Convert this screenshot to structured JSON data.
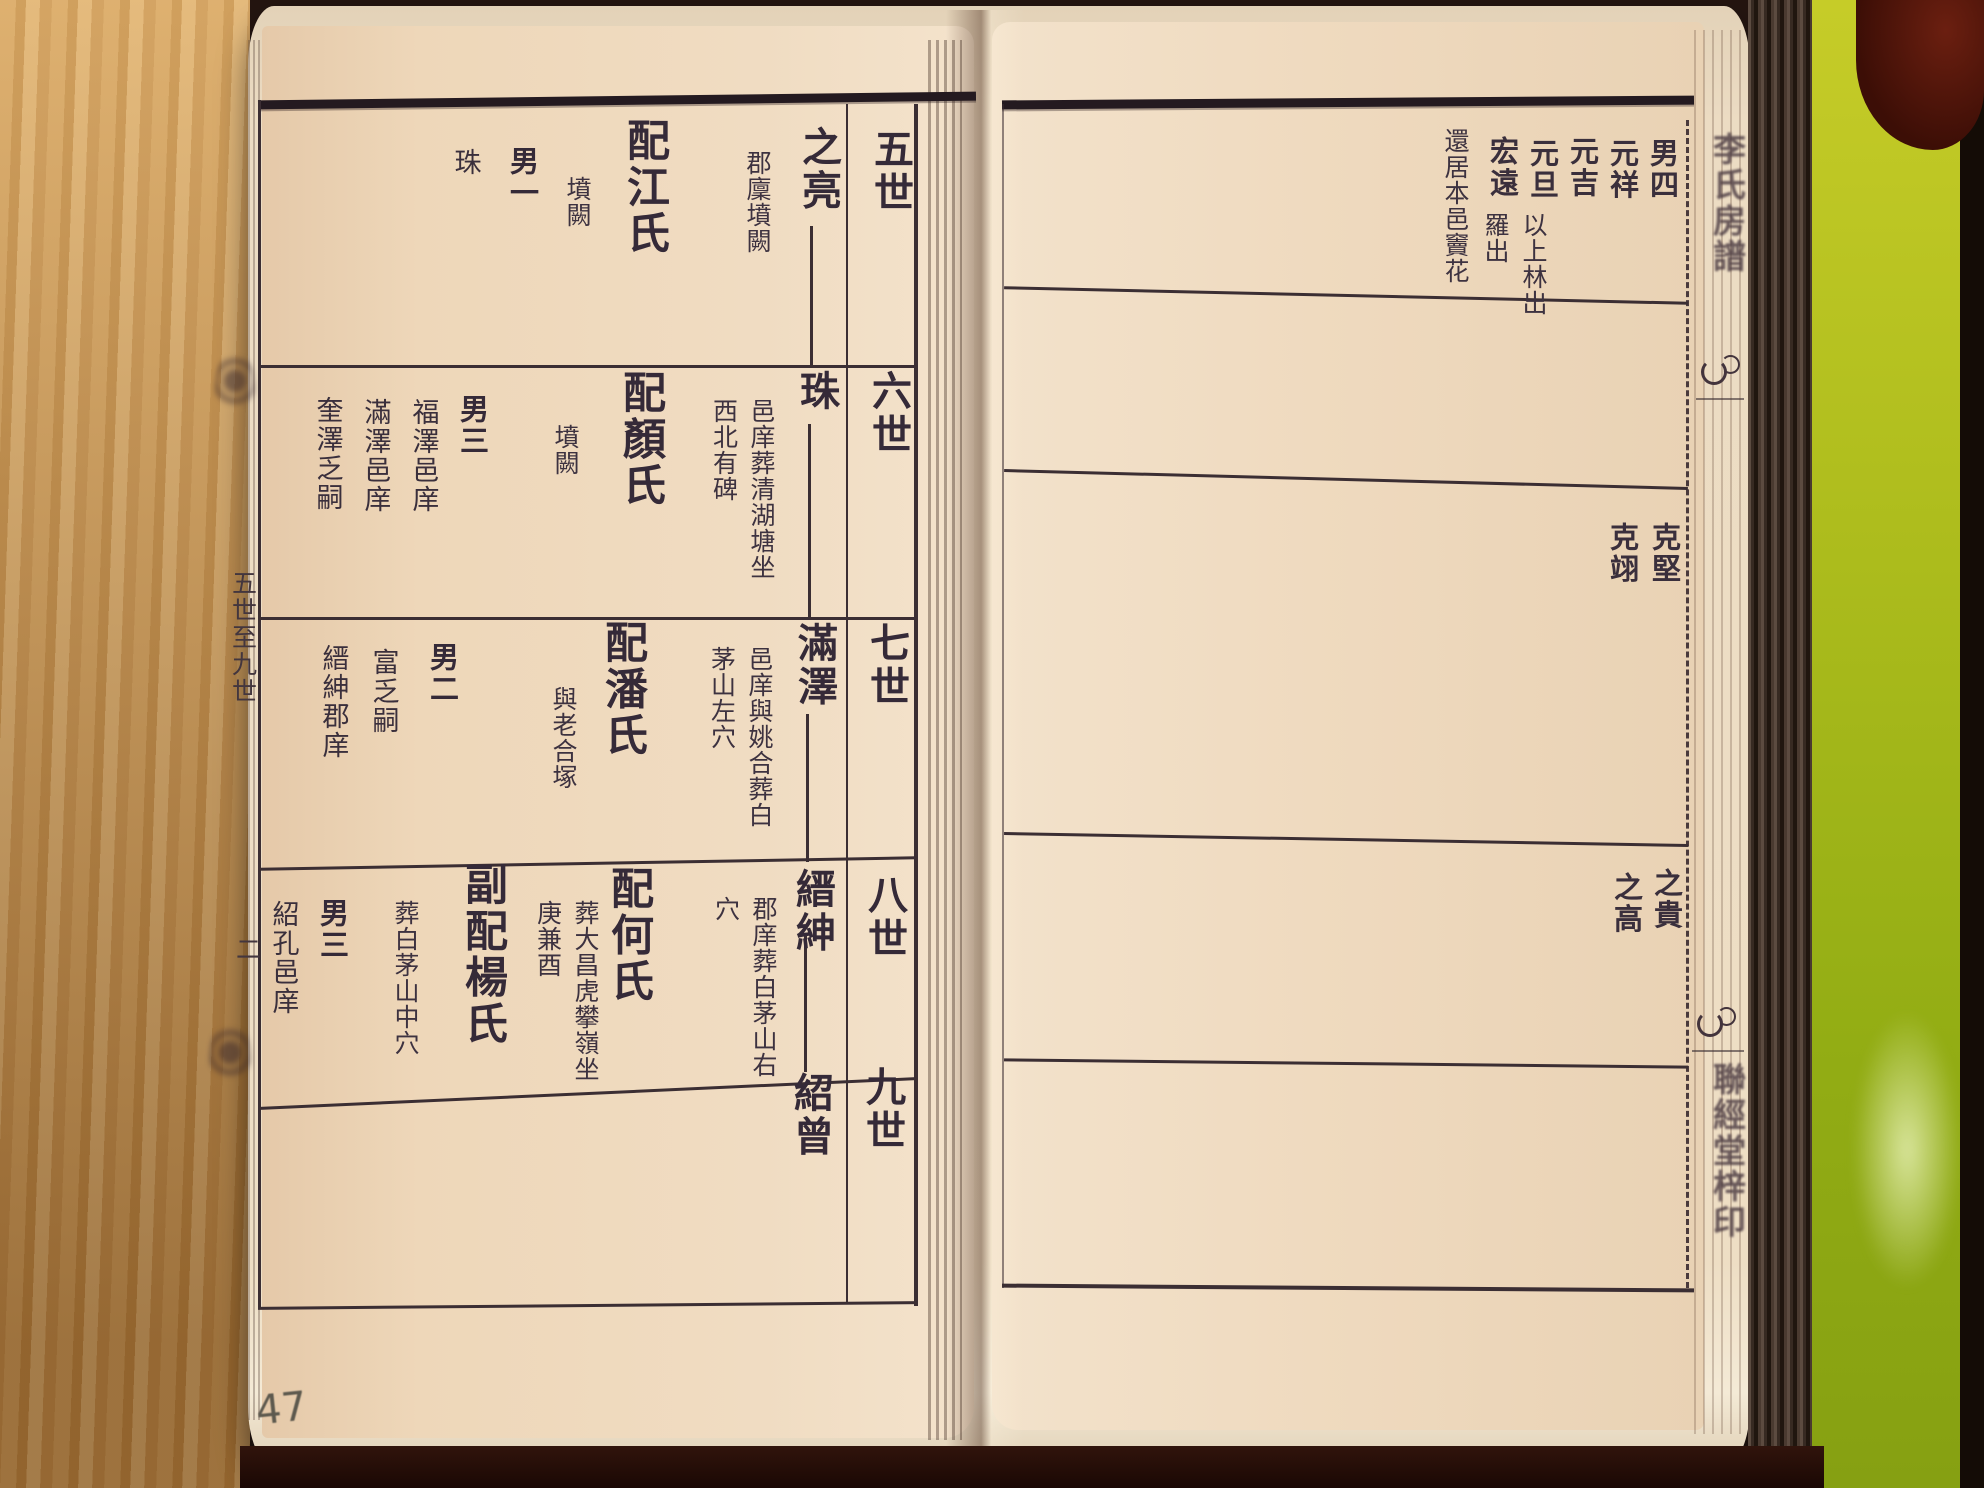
{
  "photo": {
    "description_colors": {
      "paper": "#f0dcc2",
      "ink": "#352a38",
      "wood": "#c98f4c",
      "green_cover": "#a3b81a",
      "maroon": "#4a140c"
    }
  },
  "left_page": {
    "margin": {
      "chapter_range": "五世至九世",
      "folio_marker": "二",
      "handwritten_page_number": "47"
    },
    "generation_headers": [
      "五世",
      "六世",
      "七世",
      "八世",
      "九世"
    ],
    "rows": [
      {
        "generation": "五世",
        "name": "之亮",
        "name_note": "郡廩墳闕",
        "spouse": "配江氏",
        "spouse_note": "墳闕",
        "sons_label": "男一",
        "son1": "珠"
      },
      {
        "generation": "六世",
        "name": "珠",
        "name_note": "邑庠葬清湖塘坐西北有碑",
        "spouse": "配顏氏",
        "spouse_note": "墳闕",
        "sons_label": "男三",
        "son1": "福澤邑庠",
        "son2": "滿澤邑庠",
        "son3": "奎澤乏嗣"
      },
      {
        "generation": "七世",
        "name": "滿澤",
        "name_note": "邑庠與姚合葬白茅山左穴",
        "spouse": "配潘氏",
        "spouse_note": "與老合塚",
        "sons_label": "男二",
        "son1": "富乏嗣",
        "son2": "縉紳郡庠"
      },
      {
        "generation": "八世",
        "name": "縉紳",
        "name_note": "郡庠葬白茅山右穴",
        "spouse": "配何氏",
        "spouse_note": "葬大昌虎攀嶺坐庚兼酉",
        "spouse2": "副配楊氏",
        "spouse2_note": "葬白茅山中穴",
        "sons_label": "男三",
        "son1": "紹孔邑庠"
      },
      {
        "generation": "九世",
        "name": "紹曾"
      }
    ]
  },
  "right_page": {
    "top_block": {
      "sons_label": "男四",
      "son1": "元祥",
      "son2": "元吉",
      "son3": "元旦",
      "son3_note": "以上林出",
      "son4": "宏遠",
      "son4_note": "羅出",
      "residence_note": "還居本邑竇花"
    },
    "band3_name1": "克堅",
    "band3_name2": "克翊",
    "band4_name1": "之貴",
    "band4_name2": "之高"
  },
  "spine": {
    "title": "李氏房譜",
    "publisher": "聯經堂梓印"
  }
}
